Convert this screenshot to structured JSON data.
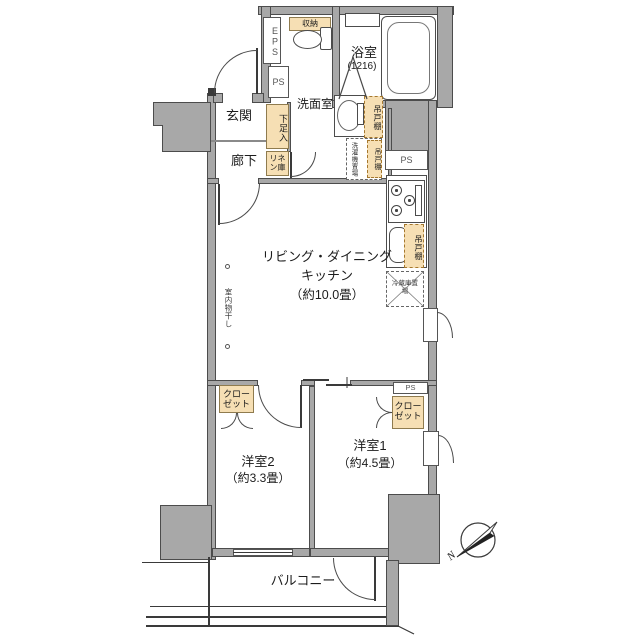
{
  "floorplan": {
    "rooms": {
      "entrance": "玄関",
      "hallway": "廊下",
      "bathroom": "浴室",
      "bathroom_size": "(1216)",
      "washroom": "洗面室",
      "ldk_line1": "リビング・ダイニング",
      "ldk_line2": "キッチン",
      "ldk_size": "（約10.0畳）",
      "bedroom2": "洋室2",
      "bedroom2_size": "（約3.3畳）",
      "bedroom1": "洋室1",
      "bedroom1_size": "（約4.5畳）",
      "balcony": "バルコニー"
    },
    "storage": {
      "shoe_cabinet": "下足入",
      "linen": "リネン庫",
      "storage": "収納",
      "closet": "クローゼット",
      "hanging_cupboard": "吊戸棚"
    },
    "equipment": {
      "washer_space": "洗濯機置場",
      "fridge_space": "冷蔵庫置場",
      "indoor_drying": "室内物干し"
    },
    "shafts": {
      "eps": "EPS",
      "ps": "PS"
    },
    "compass": {
      "north": "N"
    },
    "colors": {
      "wall": "#a8a8a8",
      "storage_fill": "#f6dfb4",
      "line": "#333333",
      "background": "#ffffff"
    }
  }
}
